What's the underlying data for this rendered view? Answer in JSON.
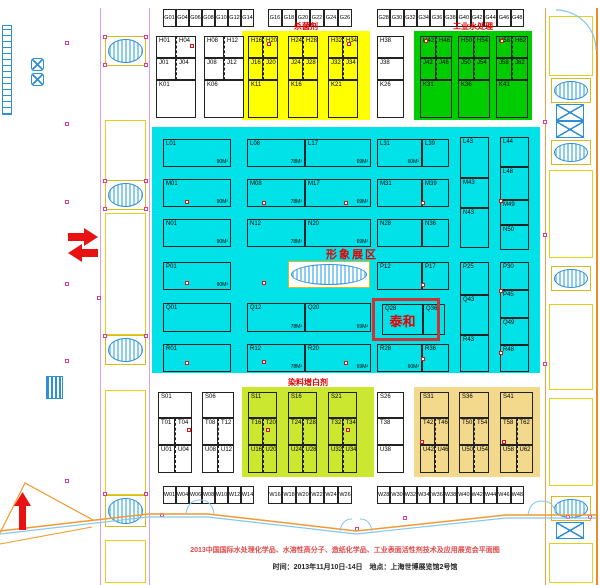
{
  "colors": {
    "cyan": "#00e2e8",
    "yellow": "#ffff00",
    "green": "#00cc00",
    "lime": "#cbe72f",
    "tan": "#f3d98b",
    "accent_red": "#e80000"
  },
  "top_strip": {
    "groups": [
      [
        "G01",
        "G04",
        "G06",
        "G08",
        "G10",
        "G12",
        "G14"
      ],
      [
        "G16",
        "G18",
        "G20",
        "G22",
        "G24",
        "G26"
      ],
      [
        "G28",
        "G30",
        "G32",
        "G34",
        "G36",
        "G38",
        "G40",
        "G42",
        "G44",
        "G46",
        "G48"
      ]
    ]
  },
  "bottom_strip": {
    "groups": [
      [
        "W01",
        "W04",
        "W06",
        "W08",
        "W10",
        "W12",
        "W14"
      ],
      [
        "W16",
        "W18",
        "W20",
        "W22",
        "W24",
        "W26"
      ],
      [
        "W28",
        "W30",
        "W32",
        "W34",
        "W36",
        "W38",
        "W40",
        "W42",
        "W44",
        "W46",
        "W48"
      ]
    ]
  },
  "upper": {
    "white_blocks": [
      {
        "rows": [
          [
            "H01",
            "H04"
          ],
          [
            "J01",
            "J04"
          ],
          [
            "K01"
          ]
        ]
      },
      {
        "rows": [
          [
            "H08",
            "H12"
          ],
          [
            "J08",
            "J12"
          ],
          [
            "K06"
          ]
        ]
      },
      {
        "rows": [
          [
            "H38"
          ],
          [
            "J38"
          ],
          [
            "K26"
          ]
        ]
      }
    ],
    "yellow_zone": {
      "label": "杀菌剂",
      "groups": [
        {
          "rows": [
            [
              "H16",
              "H20"
            ],
            [
              "J16",
              "J20"
            ],
            [
              "K11"
            ]
          ]
        },
        {
          "rows": [
            [
              "H24",
              "H28"
            ],
            [
              "J24",
              "J28"
            ],
            [
              "K16"
            ]
          ]
        },
        {
          "rows": [
            [
              "H32",
              "H34"
            ],
            [
              "J32",
              "J34"
            ],
            [
              "K21"
            ]
          ]
        }
      ]
    },
    "green_zone": {
      "label": "工业水处理",
      "groups": [
        {
          "rows": [
            [
              "H42",
              "H46"
            ],
            [
              "J42",
              "J46"
            ],
            [
              "K31"
            ]
          ]
        },
        {
          "rows": [
            [
              "H50",
              "H54"
            ],
            [
              "J50",
              "J54"
            ],
            [
              "K36"
            ]
          ]
        },
        {
          "rows": [
            [
              "H58",
              "H62"
            ],
            [
              "J58",
              "J62"
            ],
            [
              "K41"
            ]
          ]
        }
      ]
    }
  },
  "cyan": {
    "label": "形象展区",
    "taihe_label": "泰和",
    "booths": [
      {
        "id": "L01",
        "x": 163,
        "y": 139,
        "w": 68,
        "h": 28,
        "area": "90M²"
      },
      {
        "id": "L08",
        "x": 247,
        "y": 139,
        "w": 58,
        "h": 28,
        "area": "78M²"
      },
      {
        "id": "L17",
        "x": 305,
        "y": 139,
        "w": 66,
        "h": 28,
        "area": "69M²"
      },
      {
        "id": "L31",
        "x": 377,
        "y": 139,
        "w": 45,
        "h": 28,
        "area": "60M²"
      },
      {
        "id": "L39",
        "x": 422,
        "y": 139,
        "w": 27,
        "h": 28
      },
      {
        "id": "L43",
        "x": 460,
        "y": 137,
        "w": 29,
        "h": 41
      },
      {
        "id": "L44",
        "x": 500,
        "y": 137,
        "w": 29,
        "h": 30
      },
      {
        "id": "L48",
        "x": 500,
        "y": 167,
        "w": 29,
        "h": 33
      },
      {
        "id": "M01",
        "x": 163,
        "y": 179,
        "w": 68,
        "h": 28,
        "area": "90M²"
      },
      {
        "id": "M08",
        "x": 247,
        "y": 179,
        "w": 58,
        "h": 28,
        "area": "78M²"
      },
      {
        "id": "M17",
        "x": 305,
        "y": 179,
        "w": 66,
        "h": 28,
        "area": "69M²"
      },
      {
        "id": "M31",
        "x": 377,
        "y": 179,
        "w": 45,
        "h": 28
      },
      {
        "id": "M39",
        "x": 422,
        "y": 179,
        "w": 27,
        "h": 28
      },
      {
        "id": "M43",
        "x": 460,
        "y": 178,
        "w": 29,
        "h": 30
      },
      {
        "id": "M49",
        "x": 500,
        "y": 200,
        "w": 29,
        "h": 25
      },
      {
        "id": "N01",
        "x": 163,
        "y": 219,
        "w": 68,
        "h": 28,
        "area": "90M²"
      },
      {
        "id": "N12",
        "x": 247,
        "y": 219,
        "w": 58,
        "h": 28,
        "area": "78M²"
      },
      {
        "id": "N20",
        "x": 305,
        "y": 219,
        "w": 66,
        "h": 28,
        "area": "69M²"
      },
      {
        "id": "N28",
        "x": 377,
        "y": 219,
        "w": 45,
        "h": 28
      },
      {
        "id": "N36",
        "x": 422,
        "y": 219,
        "w": 27,
        "h": 28
      },
      {
        "id": "N43",
        "x": 460,
        "y": 208,
        "w": 29,
        "h": 40
      },
      {
        "id": "N50",
        "x": 500,
        "y": 225,
        "w": 29,
        "h": 25
      },
      {
        "id": "P01",
        "x": 163,
        "y": 262,
        "w": 68,
        "h": 28,
        "area": "90M²"
      },
      {
        "id": "P12",
        "x": 377,
        "y": 262,
        "w": 45,
        "h": 28
      },
      {
        "id": "P17",
        "x": 422,
        "y": 262,
        "w": 27,
        "h": 28
      },
      {
        "id": "P25",
        "x": 460,
        "y": 262,
        "w": 29,
        "h": 33
      },
      {
        "id": "P30",
        "x": 500,
        "y": 262,
        "w": 29,
        "h": 28
      },
      {
        "id": "P45",
        "x": 500,
        "y": 290,
        "w": 29,
        "h": 28
      },
      {
        "id": "Q01",
        "x": 163,
        "y": 303,
        "w": 68,
        "h": 29
      },
      {
        "id": "Q12",
        "x": 247,
        "y": 303,
        "w": 58,
        "h": 29,
        "area": "78M²"
      },
      {
        "id": "Q20",
        "x": 305,
        "y": 303,
        "w": 66,
        "h": 29,
        "area": "69M²"
      },
      {
        "id": "Q28",
        "x": 382,
        "y": 304,
        "w": 41,
        "h": 31
      },
      {
        "id": "Q36",
        "x": 423,
        "y": 304,
        "w": 22,
        "h": 31
      },
      {
        "id": "Q43",
        "x": 460,
        "y": 295,
        "w": 29,
        "h": 40
      },
      {
        "id": "Q49",
        "x": 500,
        "y": 318,
        "w": 29,
        "h": 27
      },
      {
        "id": "R01",
        "x": 163,
        "y": 344,
        "w": 68,
        "h": 28
      },
      {
        "id": "R12",
        "x": 247,
        "y": 344,
        "w": 58,
        "h": 28,
        "area": "78M²"
      },
      {
        "id": "R20",
        "x": 305,
        "y": 344,
        "w": 66,
        "h": 28,
        "area": "69M²"
      },
      {
        "id": "R28",
        "x": 377,
        "y": 344,
        "w": 45,
        "h": 28,
        "area": "60M²"
      },
      {
        "id": "R36",
        "x": 422,
        "y": 344,
        "w": 27,
        "h": 28
      },
      {
        "id": "R43",
        "x": 460,
        "y": 335,
        "w": 29,
        "h": 37
      },
      {
        "id": "R48",
        "x": 500,
        "y": 345,
        "w": 29,
        "h": 27
      }
    ]
  },
  "lower": {
    "white_blocks": [
      {
        "rows": [
          [
            "S01"
          ],
          [
            "T01",
            "T04"
          ],
          [
            "U01",
            "U04"
          ]
        ]
      },
      {
        "rows": [
          [
            "S06"
          ],
          [
            "T08",
            "T12"
          ],
          [
            "U08",
            "U12"
          ]
        ]
      },
      {
        "rows": [
          [
            "S26"
          ],
          [
            "T38"
          ],
          [
            "U38"
          ]
        ]
      }
    ],
    "lime_zone": {
      "label": "染料增白剂",
      "groups": [
        {
          "rows": [
            [
              "S11"
            ],
            [
              "T16",
              "T20"
            ],
            [
              "U16",
              "U20"
            ]
          ]
        },
        {
          "rows": [
            [
              "S16"
            ],
            [
              "T24",
              "T28"
            ],
            [
              "U24",
              "U28"
            ]
          ]
        },
        {
          "rows": [
            [
              "S21"
            ],
            [
              "T32",
              "T34"
            ],
            [
              "U32",
              "U34"
            ]
          ]
        }
      ]
    },
    "tan_zone": {
      "groups": [
        {
          "rows": [
            [
              "S31"
            ],
            [
              "T42",
              "T46"
            ],
            [
              "U42",
              "U46"
            ]
          ]
        },
        {
          "rows": [
            [
              "S36"
            ],
            [
              "T50",
              "T54"
            ],
            [
              "U50",
              "U54"
            ]
          ]
        },
        {
          "rows": [
            [
              "S41"
            ],
            [
              "T58",
              "T62"
            ],
            [
              "U58",
              "U62"
            ]
          ]
        }
      ]
    }
  },
  "footer": {
    "line1": "2013中国国际水处理化学品、水溶性高分子、造纸化学品、工业表面活性剂技术及应用展览会平面图",
    "line2": "时间：2013年11月10日-14日　地点：上海世博展览馆2号馆"
  }
}
